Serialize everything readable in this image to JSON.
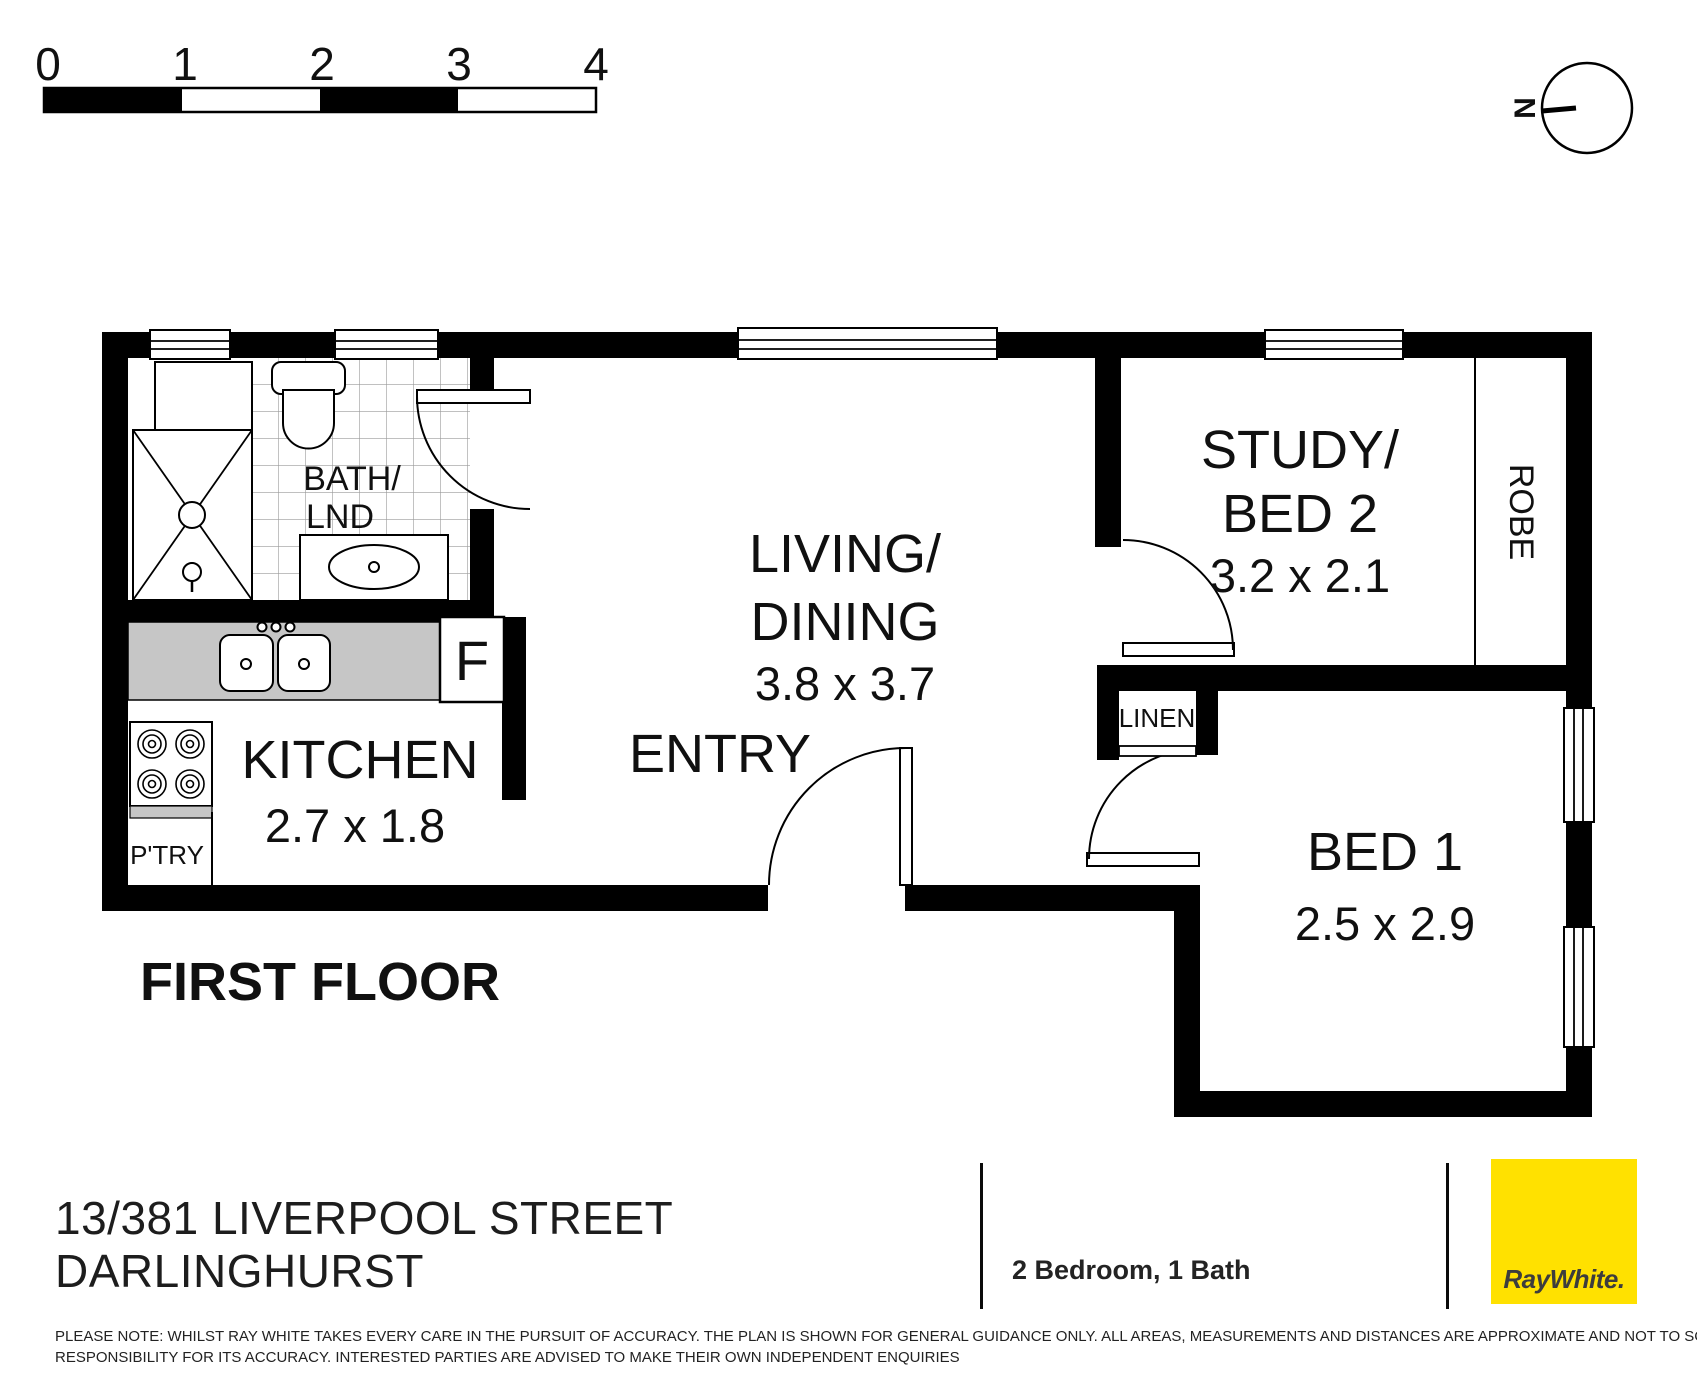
{
  "scale_bar": {
    "ticks": [
      "0",
      "1",
      "2",
      "3",
      "4"
    ]
  },
  "compass": {
    "north_label": "N"
  },
  "plan": {
    "floor_label": "FIRST FLOOR",
    "colors": {
      "wall": "#000000",
      "counter": "#c6c6c6",
      "tile_line": "#9a9a9a",
      "fixture_stroke": "#000000"
    },
    "rooms": {
      "bath": {
        "name_line1": "BATH/",
        "name_line2": "LND"
      },
      "kitchen": {
        "name": "KITCHEN",
        "dims": "2.7 x 1.8"
      },
      "pantry": {
        "name": "P'TRY"
      },
      "fridge": {
        "name": "F"
      },
      "living": {
        "name_line1": "LIVING/",
        "name_line2": "DINING",
        "dims": "3.8 x 3.7"
      },
      "entry": {
        "name": "ENTRY"
      },
      "study": {
        "name_line1": "STUDY/",
        "name_line2": "BED 2",
        "dims": "3.2 x 2.1"
      },
      "robe": {
        "name": "ROBE"
      },
      "linen": {
        "name": "LINEN"
      },
      "bed1": {
        "name": "BED 1",
        "dims": "2.5 x 2.9"
      }
    }
  },
  "footer": {
    "address_line1": "13/381 LIVERPOOL STREET",
    "address_line2": "DARLINGHURST",
    "summary": "2 Bedroom, 1 Bath",
    "brand": {
      "name": "RayWhite.",
      "bg": "#ffe100",
      "text_color": "#3d3d3d"
    },
    "disclaimer_line1": "PLEASE NOTE: WHILST RAY WHITE TAKES EVERY CARE IN THE PURSUIT OF ACCURACY. THE PLAN IS SHOWN FOR GENERAL GUIDANCE ONLY. ALL AREAS, MEASUREMENTS AND DISTANCES ARE APPROXIMATE AND NOT TO SCALE RAY WHITE AND OUR VENDOR WILL ACCEPT NO",
    "disclaimer_line2": "RESPONSIBILITY FOR ITS ACCURACY. INTERESTED PARTIES ARE ADVISED TO MAKE THEIR OWN INDEPENDENT ENQUIRIES"
  }
}
